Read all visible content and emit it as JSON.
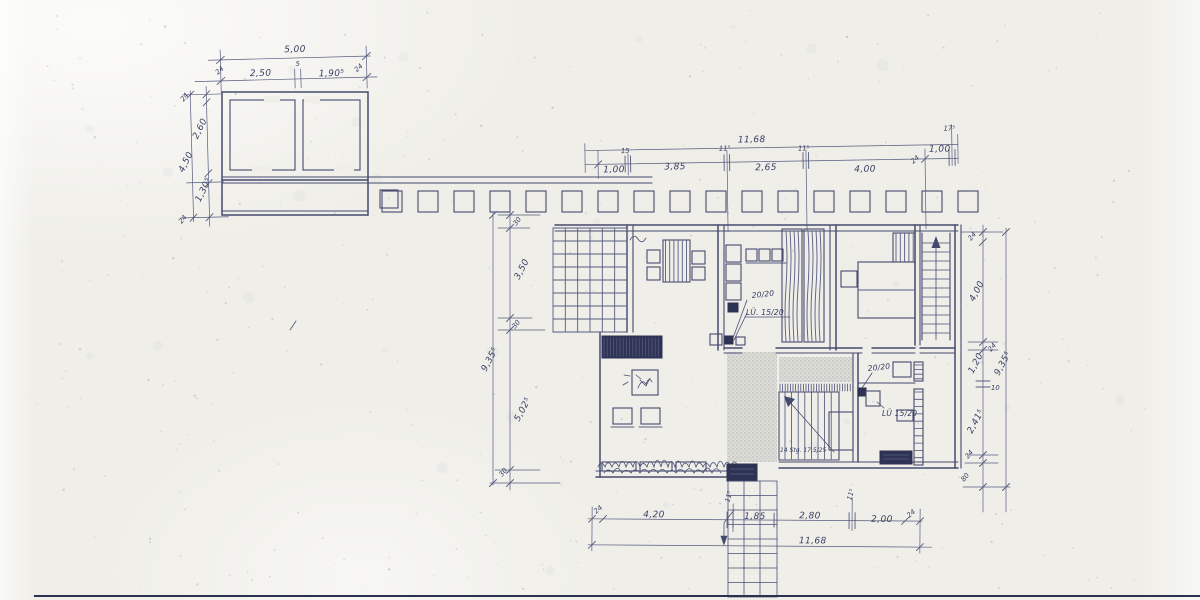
{
  "page": {
    "title": "Scanned architectural floor plan (blueprint)"
  },
  "outbuilding": {
    "top_total": "5,00",
    "top_wall_left": "24",
    "top_seg_left": "2,50",
    "top_wall_mid": "5",
    "top_seg_right": "1,90⁵",
    "top_wall_right": "24",
    "left_wall_top": "24",
    "left_seg_top": "2,60",
    "left_total": "4,50",
    "left_seg_bottom": "1,30⁵",
    "left_wall_bottom": "24"
  },
  "top_chain": {
    "total": "11,68",
    "seg1": "1,00",
    "tick1": "15",
    "seg2": "3,85",
    "tick2": "11⁵",
    "seg3": "2,65",
    "tick3": "11⁵",
    "seg4": "4,00",
    "tick4": "24",
    "seg5": "1,00",
    "tick5": "17⁵"
  },
  "left_chain": {
    "wall_top": "30",
    "seg_top": "3,50",
    "wall_mid": "30",
    "seg_bottom": "5,02⁵",
    "wall_bottom": "30",
    "total": "9,35⁵"
  },
  "right_chain": {
    "wall_top": "24",
    "seg1": "4,00",
    "wall2": "24",
    "seg2": "1,20",
    "wall3": "10",
    "seg3": "2,41⁵",
    "wall4": "24",
    "seg4": "80",
    "total": "9,35⁵"
  },
  "bottom_chain": {
    "wall_left": "24",
    "seg1": "4,20",
    "tick1": "11⁵",
    "seg2": "1,85",
    "seg3": "2,80",
    "tick2": "11⁵",
    "seg4": "2,00",
    "wall_right": "24",
    "total": "11,68"
  },
  "annotations": {
    "kitchen_duct": "20/20",
    "kitchen_vent": "LÜ. 15/20",
    "bath_duct": "20/20",
    "bath_vent": "LÜ 15/20",
    "stair_note": "14 Stg. 17,5/25"
  },
  "colors": {
    "ink": "#454b6e",
    "paper": "#efeee8",
    "dark_fill": "#2e3354"
  }
}
